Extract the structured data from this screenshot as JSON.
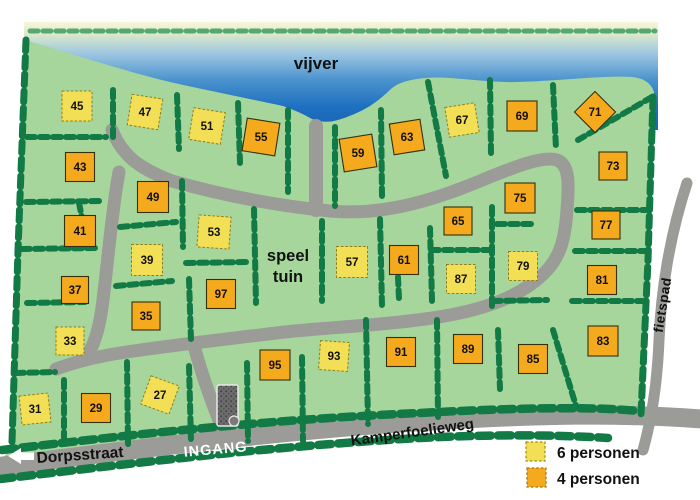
{
  "map": {
    "labels": {
      "water": "vijver",
      "playground_line1": "speel",
      "playground_line2": "tuin",
      "entrance": "INGANG",
      "street_left": "Dorpsstraat",
      "street_bottom": "Kamperfoelieweg",
      "bike_path": "fietspad"
    },
    "legend": [
      {
        "label": "6 personen",
        "type": "six",
        "color": "#f3df55"
      },
      {
        "label": "4 personen",
        "type": "four",
        "color": "#f5a91d"
      }
    ],
    "colors": {
      "land": "#a6d69c",
      "hedge": "#117a45",
      "road": "#9b9b97",
      "water_deep": "#1c6fc0",
      "lot_six_person": "#f3df55",
      "lot_four_person": "#f5a91d"
    },
    "lots": [
      {
        "number": "45",
        "type": "six",
        "x": 77,
        "y": 106,
        "rot": 0,
        "s": 30
      },
      {
        "number": "47",
        "type": "six",
        "x": 145,
        "y": 112,
        "rot": 9,
        "s": 31
      },
      {
        "number": "51",
        "type": "six",
        "x": 207,
        "y": 126,
        "rot": 9,
        "s": 32
      },
      {
        "number": "55",
        "type": "four",
        "x": 261,
        "y": 137,
        "rot": 9,
        "s": 33
      },
      {
        "number": "59",
        "type": "four",
        "x": 358,
        "y": 153,
        "rot": -9,
        "s": 33
      },
      {
        "number": "63",
        "type": "four",
        "x": 407,
        "y": 137,
        "rot": -9,
        "s": 31
      },
      {
        "number": "67",
        "type": "six",
        "x": 462,
        "y": 120,
        "rot": -9,
        "s": 30
      },
      {
        "number": "69",
        "type": "four",
        "x": 522,
        "y": 116,
        "rot": 0,
        "s": 30
      },
      {
        "number": "71",
        "type": "four",
        "x": 595,
        "y": 112,
        "rot": 45,
        "s": 29
      },
      {
        "number": "73",
        "type": "four",
        "x": 613,
        "y": 166,
        "rot": 0,
        "s": 28
      },
      {
        "number": "43",
        "type": "four",
        "x": 80,
        "y": 167,
        "rot": 0,
        "s": 29
      },
      {
        "number": "49",
        "type": "four",
        "x": 153,
        "y": 197,
        "rot": 0,
        "s": 31
      },
      {
        "number": "75",
        "type": "four",
        "x": 520,
        "y": 198,
        "rot": 0,
        "s": 30
      },
      {
        "number": "41",
        "type": "four",
        "x": 80,
        "y": 231,
        "rot": 0,
        "s": 31
      },
      {
        "number": "53",
        "type": "six",
        "x": 214,
        "y": 232,
        "rot": 4,
        "s": 32
      },
      {
        "number": "65",
        "type": "four",
        "x": 458,
        "y": 221,
        "rot": 0,
        "s": 28
      },
      {
        "number": "39",
        "type": "six",
        "x": 147,
        "y": 260,
        "rot": 0,
        "s": 31
      },
      {
        "number": "57",
        "type": "six",
        "x": 352,
        "y": 262,
        "rot": 0,
        "s": 31
      },
      {
        "number": "61",
        "type": "four",
        "x": 404,
        "y": 260,
        "rot": 0,
        "s": 29
      },
      {
        "number": "79",
        "type": "six",
        "x": 523,
        "y": 266,
        "rot": 0,
        "s": 29
      },
      {
        "number": "77",
        "type": "four",
        "x": 606,
        "y": 225,
        "rot": 0,
        "s": 28
      },
      {
        "number": "87",
        "type": "six",
        "x": 461,
        "y": 279,
        "rot": 0,
        "s": 29
      },
      {
        "number": "37",
        "type": "four",
        "x": 75,
        "y": 290,
        "rot": 0,
        "s": 27
      },
      {
        "number": "97",
        "type": "four",
        "x": 221,
        "y": 294,
        "rot": 0,
        "s": 29
      },
      {
        "number": "81",
        "type": "four",
        "x": 602,
        "y": 280,
        "rot": 0,
        "s": 29
      },
      {
        "number": "35",
        "type": "four",
        "x": 146,
        "y": 316,
        "rot": 0,
        "s": 28
      },
      {
        "number": "33",
        "type": "six",
        "x": 70,
        "y": 341,
        "rot": 0,
        "s": 28
      },
      {
        "number": "83",
        "type": "four",
        "x": 603,
        "y": 341,
        "rot": 0,
        "s": 30
      },
      {
        "number": "95",
        "type": "four",
        "x": 275,
        "y": 365,
        "rot": 0,
        "s": 30
      },
      {
        "number": "93",
        "type": "six",
        "x": 334,
        "y": 356,
        "rot": 4,
        "s": 29
      },
      {
        "number": "91",
        "type": "four",
        "x": 401,
        "y": 352,
        "rot": 0,
        "s": 29
      },
      {
        "number": "89",
        "type": "four",
        "x": 468,
        "y": 349,
        "rot": 0,
        "s": 29
      },
      {
        "number": "85",
        "type": "four",
        "x": 533,
        "y": 359,
        "rot": 0,
        "s": 29
      },
      {
        "number": "27",
        "type": "six",
        "x": 160,
        "y": 395,
        "rot": 20,
        "s": 30
      },
      {
        "number": "29",
        "type": "four",
        "x": 96,
        "y": 408,
        "rot": 0,
        "s": 29
      },
      {
        "number": "31",
        "type": "six",
        "x": 35,
        "y": 409,
        "rot": -6,
        "s": 29
      }
    ]
  }
}
